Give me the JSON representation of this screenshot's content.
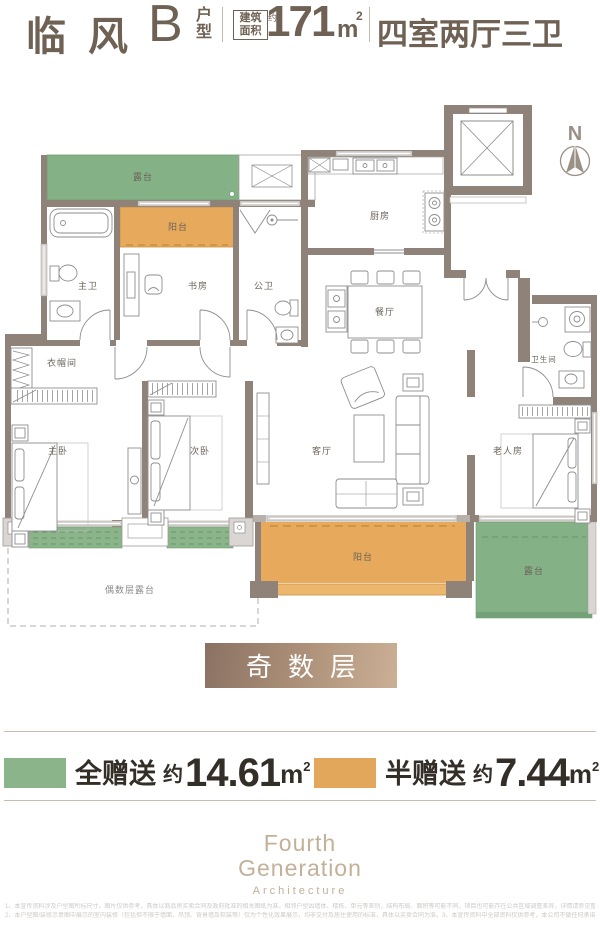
{
  "header": {
    "title": "临风",
    "unit": "B",
    "unit_suffix": "户型",
    "badge_line1": "建筑",
    "badge_line2": "面积",
    "badge_approx": "约",
    "area_value": "171",
    "area_unit": "m",
    "area_sup": "2",
    "layout": "四室两厅三卫"
  },
  "compass": {
    "label": "N"
  },
  "plan": {
    "rooms": {
      "terrace_top": "露台",
      "balcony_top": "阳台",
      "master_bath": "主卫",
      "study": "书房",
      "public_bath": "公卫",
      "kitchen": "厨房",
      "dining": "餐厅",
      "cloakroom": "衣帽间",
      "master_bedroom": "主卧",
      "second_bedroom": "次卧",
      "living": "客厅",
      "bathroom": "卫生间",
      "elder_room": "老人房",
      "balcony_bottom": "阳台",
      "terrace_bottom": "露台",
      "even_terrace": "偶数层露台"
    },
    "colors": {
      "gift_full": "#84b286",
      "gift_half": "#e7a95b",
      "wall": "#8f8379",
      "window": "#dad6d3"
    }
  },
  "floor_tag": {
    "label": "奇数层",
    "gradient_from": "#8a7263",
    "gradient_to": "#cbb096"
  },
  "legend": {
    "full": {
      "label": "全赠送",
      "approx": "约",
      "value": "14.61",
      "unit": "m",
      "sup": "2",
      "color": "#8cb48b"
    },
    "half": {
      "label": "半赠送",
      "approx": "约",
      "value": "7.44",
      "unit": "m",
      "sup": "2",
      "color": "#e3a75c"
    }
  },
  "logo": {
    "line1": "Fourth",
    "line2": "Generation",
    "line3": "Architecture"
  },
  "disclaimer": {
    "line1": "1、本宣传资料涉及户型图所标尺寸，图片仅供参考，具体以商品房买卖合同及政府批准的相关图纸为准，相邻户型因墙体、楼栋、单元等差别，结构布局、面积等可能不同，项目也可能存在公共区域调整差异，详情请参见整体平面图，重点关注其中各户型的相对位置关系。",
    "line2": "2、本户型图/装修示意图中展示的室内装修（包括但不限于墙面、吊顶、背景墙及软装等）仅为个性化效果展示，均非交付及居住使用的标准，具体以买卖合同为准。3、本宣传资料中全部资料仅供参考，本公司不做任何承诺或保证，一切以政府最终批文为准。"
  }
}
